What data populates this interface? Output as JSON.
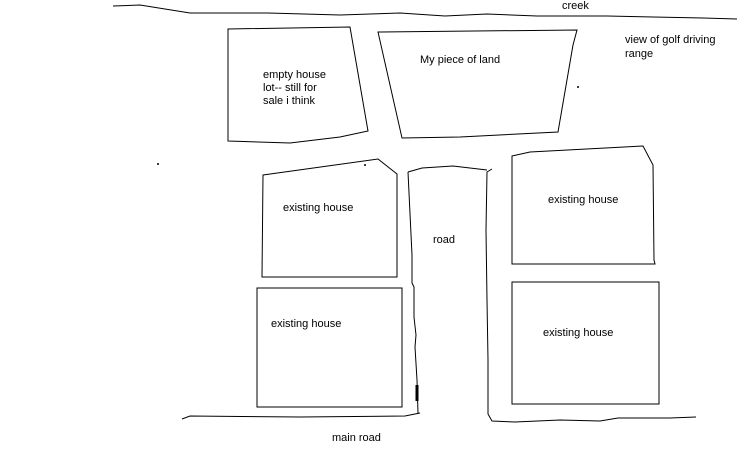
{
  "sketch": {
    "background_color": "#ffffff",
    "ink_color": "#000000",
    "labels": {
      "creek": "creek",
      "golf_view": "view of golf driving\nrange",
      "empty_lot": "empty house\nlot-- still for\nsale i think",
      "my_land": "My piece of land",
      "house_nw": "existing house",
      "house_ne": "existing house",
      "house_sw": "existing house",
      "house_se": "existing house",
      "road": "road",
      "main_road": "main road"
    }
  }
}
